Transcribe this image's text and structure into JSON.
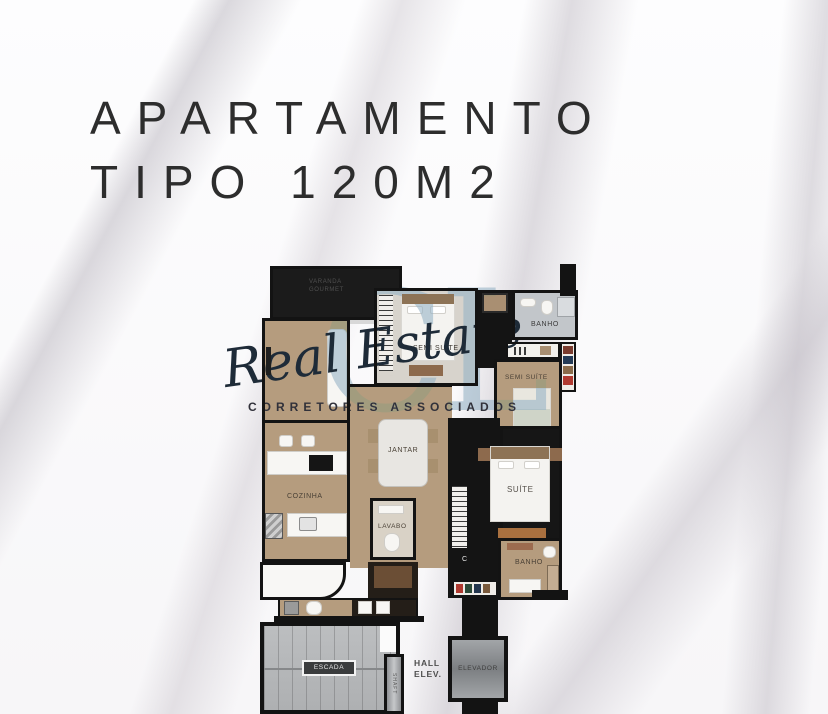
{
  "title": {
    "line1": "APARTAMENTO",
    "line2": "TIPO 120M2",
    "color": "#2d2d2d"
  },
  "watermark": {
    "monogram": "CL",
    "script": "Real Estate",
    "subtitle": "CORRETORES ASSOCIADOS",
    "monogram_color": "#94b2c4",
    "script_color": "#1e2b38"
  },
  "floorplan": {
    "rooms": {
      "varanda_gourmet": "VARANDA GOURMET",
      "sala_tv": "SALA TV",
      "semi_suite_top": "SEMI SUÍTE",
      "banho_top": "BANHO",
      "semi_suite_right": "SEMI SUÍTE",
      "jantar": "JANTAR",
      "suite": "SUÍTE",
      "cozinha": "COZINHA",
      "lavabo": "LAVABO",
      "banho_suite": "BANHO",
      "circulacao": "C",
      "escada": "ESCADA",
      "shaft": "SHAFT",
      "hall_elev": "HALL ELEV.",
      "elevador": "ELEVADOR"
    },
    "colors": {
      "wall": "#131313",
      "floor_wood": "#b59c7e",
      "floor_bath_gray": "#c2c6ca",
      "floor_bedroom": "#d7d3cc",
      "dark_floor": "#161616",
      "stairs_gray": "#b6b8ba"
    }
  }
}
